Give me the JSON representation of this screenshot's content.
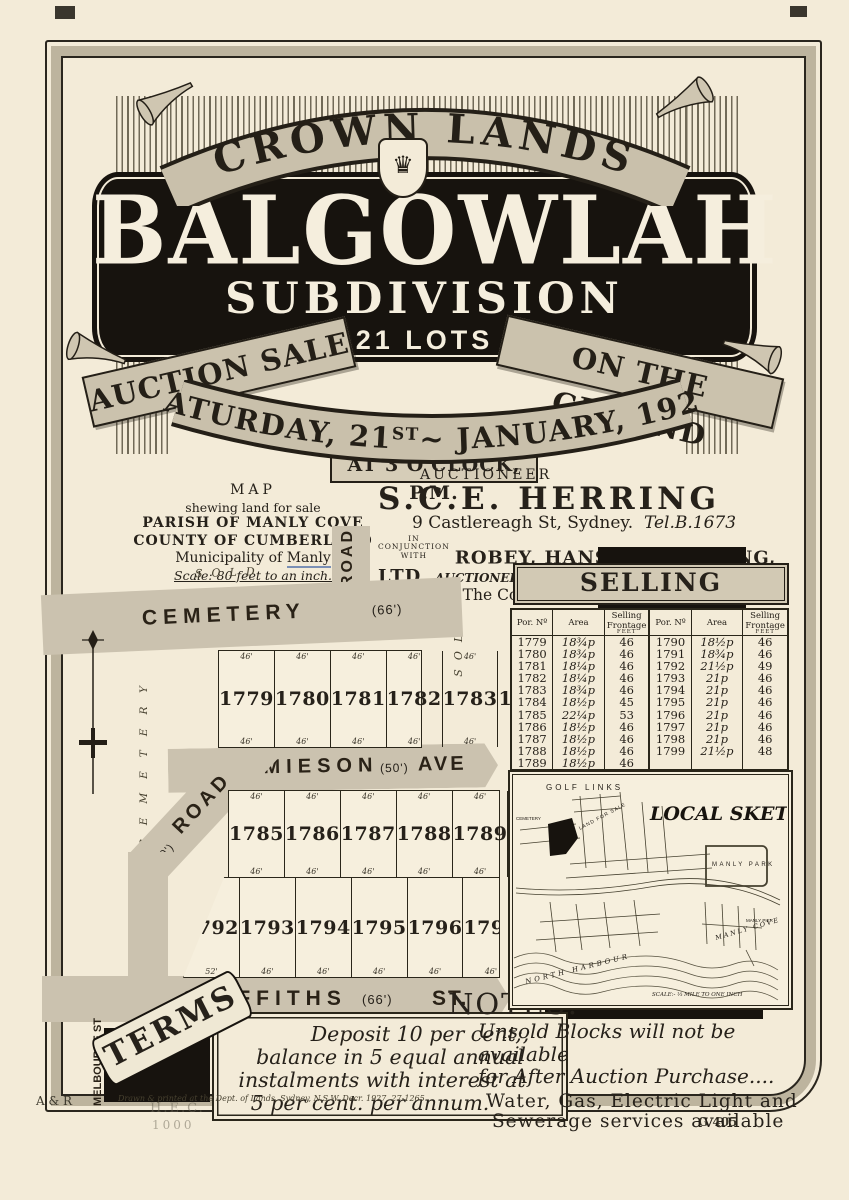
{
  "masthead": {
    "banner": "CROWN LANDS",
    "title": "BALGOWLAH",
    "subtitle": "SUBDIVISION",
    "lots_line": "21 LOTS",
    "ribbon_left": "AUCTION SALE",
    "ribbon_right": "ON THE GROUND",
    "date_pre": "SATURDAY, 21",
    "date_sup": "ST",
    "date_post": "~ JANUARY, 1928",
    "time_line": "AT 3 O'CLOCK, P.M."
  },
  "auctioneer": {
    "heading": "AUCTIONEER",
    "name": "S.C.E. HERRING",
    "address1": "9 Castlereagh St, Sydney.",
    "tel1": "Tel.B.1673",
    "conjunction_1": "IN",
    "conjunction_2": "CONJUNCTION",
    "conjunction_3": "WITH",
    "firm": "ROBEY, HANSON & STRONG, LTD.,",
    "firm_role": "AUCTIONEERS",
    "address2": "42 The Corso, Manly.",
    "tel2": "Tel 15 & 19 Manly"
  },
  "map_legend": {
    "title": "MAP",
    "line1": "shewing land for sale",
    "line2": "PARISH OF MANLY COVE",
    "line3": "COUNTY OF CUMBERLAND",
    "line4_pre": "Municipality of ",
    "line4_em": "Manly",
    "scale": "Scale: 80 feet to an inch."
  },
  "map": {
    "sold_label": "SOLD",
    "cemetery_road": "CEMETERY",
    "cemetery_width": "(66')",
    "road_label": "ROAD",
    "road_width": "(40')",
    "jamieson": "JAMIESON",
    "jamieson_width": "(50')",
    "jamieson_suffix": "AVE",
    "griffiths": "GRIFFITHS",
    "griffiths_width": "(66')",
    "griffiths_suffix": "ST.",
    "melbourne": "MELBOURNE ST",
    "bellevue": "BELLEVUE ST",
    "cemetery_side": "CEMETERY",
    "lot_rows": [
      {
        "lots": [
          "1779",
          "1780",
          "1781",
          "1782",
          "1783",
          "1784"
        ],
        "top": [
          "46'",
          "46'",
          "46'",
          "46'",
          "46'",
          "45'"
        ],
        "bottom": [
          "46'",
          "46'",
          "46'",
          "46'",
          "46'",
          "45'9\""
        ]
      },
      {
        "lots": [
          "1785",
          "1786",
          "1787",
          "1788",
          "1789",
          "1790",
          "1791"
        ],
        "top": [
          "46'",
          "46'",
          "46'",
          "46'",
          "46'",
          "46'",
          "46'"
        ],
        "bottom": [
          "46'",
          "46'",
          "46'",
          "46'",
          "46'",
          "46'",
          "46'"
        ]
      },
      {
        "lots": [
          "1792",
          "1793",
          "1794",
          "1795",
          "1796",
          "1797",
          "1798",
          "1799"
        ],
        "top": [],
        "bottom": [
          "52'",
          "46'",
          "46'",
          "46'",
          "46'",
          "46'",
          "46'",
          "47'8\""
        ]
      }
    ]
  },
  "selling_frontages": {
    "title": "SELLING FRONTAGES",
    "headers": [
      "Por. Nº",
      "Area",
      "Selling Frontage"
    ],
    "feet_label": "FEET",
    "rows_left": [
      [
        "1779",
        "18¾p",
        "46"
      ],
      [
        "1780",
        "18¾p",
        "46"
      ],
      [
        "1781",
        "18¼p",
        "46"
      ],
      [
        "1782",
        "18¼p",
        "46"
      ],
      [
        "1783",
        "18¾p",
        "46"
      ],
      [
        "1784",
        "18½p",
        "45"
      ],
      [
        "1785",
        "22¼p",
        "53"
      ],
      [
        "1786",
        "18½p",
        "46"
      ],
      [
        "1787",
        "18½p",
        "46"
      ],
      [
        "1788",
        "18½p",
        "46"
      ],
      [
        "1789",
        "18½p",
        "46"
      ]
    ],
    "rows_right": [
      [
        "1790",
        "18½p",
        "46"
      ],
      [
        "1791",
        "18¾p",
        "46"
      ],
      [
        "1792",
        "21½p",
        "49"
      ],
      [
        "1793",
        "21p",
        "46"
      ],
      [
        "1794",
        "21p",
        "46"
      ],
      [
        "1795",
        "21p",
        "46"
      ],
      [
        "1796",
        "21p",
        "46"
      ],
      [
        "1797",
        "21p",
        "46"
      ],
      [
        "1798",
        "21p",
        "46"
      ],
      [
        "1799",
        "21½p",
        "48"
      ]
    ]
  },
  "local_sketch": {
    "title": "LOCAL SKETCH",
    "golf_links": "GOLF LINKS",
    "land_for_sale": "LAND FOR SALE",
    "cemetery": "CEMETERY",
    "manly_park": "MANLY PARK",
    "manly_cove": "MANLY COVE",
    "manly_pier": "MANLY PIER",
    "north_harbour": "NORTH  HARBOUR",
    "scale": "SCALE:- ⅓ MILE TO ONE INCH"
  },
  "terms": {
    "ribbon": "TERMS",
    "lines": [
      "Deposit 10 per cent;,",
      "balance in 5 equal annual",
      "instalments with interest at",
      "5 per cent. per annum."
    ]
  },
  "notes": {
    "heading": "NOTES:",
    "line1": "Unsold Blocks will not be available",
    "line2": "for After Auction Purchase....",
    "line3": "Water, Gas, Electric Light and",
    "line4": "Sewerage services available"
  },
  "footer": {
    "imprint": "Drawn & printed at the Dept. of Lands, Sydney, N.S.W. Decr. 1927.  27-1265",
    "stamp_ar": "A & R",
    "stamp_robinson": "H.E.C. Robinson",
    "stamp_1000": "1000",
    "plate": "G 405"
  },
  "colors": {
    "paper": "#f3ebd8",
    "ink": "#26211a",
    "ribbon_gray": "#cbc2ad",
    "road_gray": "#cbc2af",
    "plaque_black": "#17130e"
  }
}
